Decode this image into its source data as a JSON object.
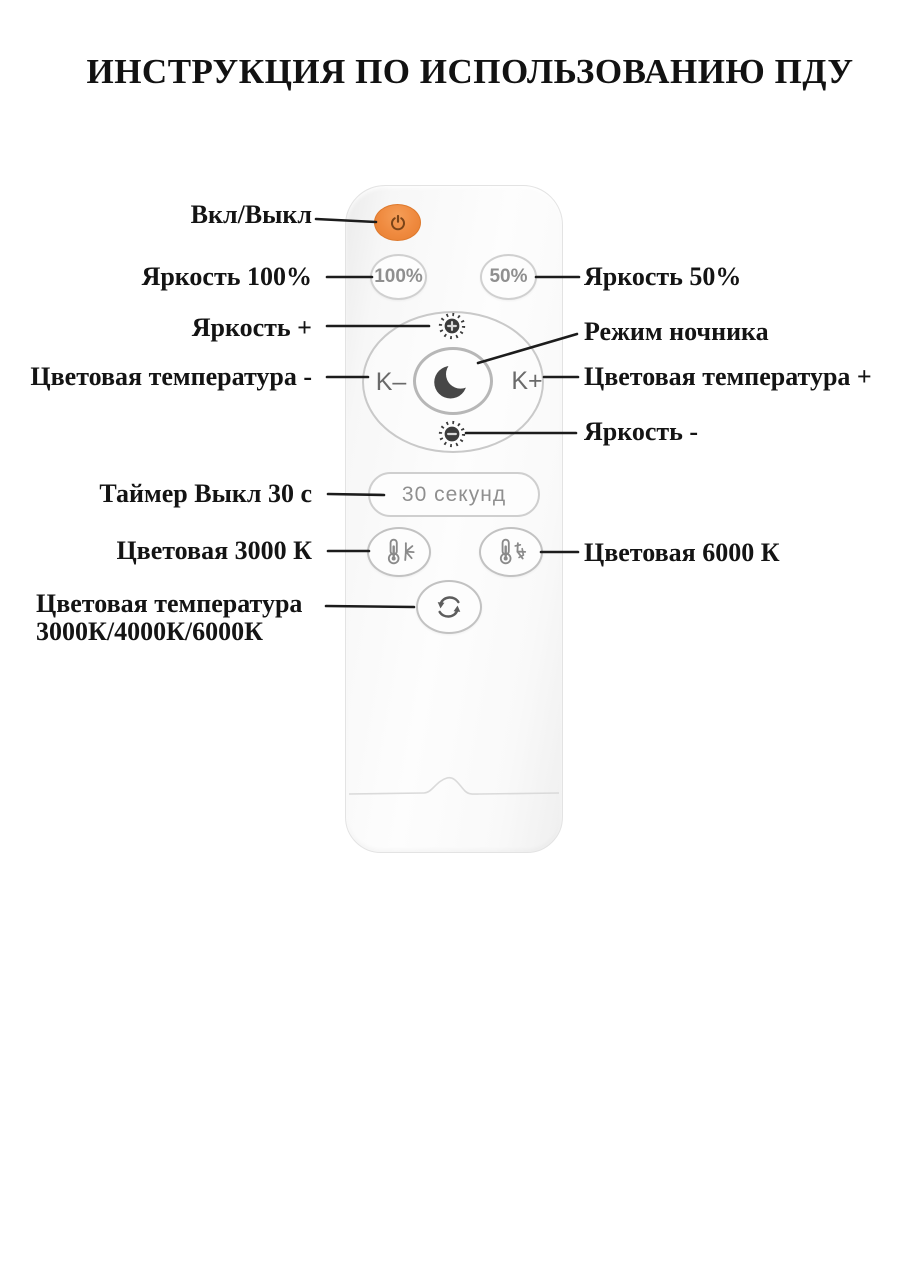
{
  "title": "ИНСТРУКЦИЯ ПО ИСПОЛЬЗОВАНИЮ ПДУ",
  "annotations": {
    "power": "Вкл/Выкл",
    "brightness_100": "Яркость 100%",
    "brightness_50": "Яркость 50%",
    "brightness_plus": "Яркость +",
    "night_mode": "Режим ночника",
    "color_temp_minus": "Цветовая температура -",
    "color_temp_plus": "Цветовая температура +",
    "brightness_minus": "Яркость -",
    "timer_off_30": "Таймер Выкл 30 с",
    "color_3000": "Цветовая 3000 К",
    "color_6000": "Цветовая 6000 К",
    "color_cycle_line1": "Цветовая температура",
    "color_cycle_line2": "3000К/4000К/6000К"
  },
  "remote": {
    "buttons": {
      "brightness_100_label": "100%",
      "brightness_50_label": "50%",
      "k_minus_label": "K–",
      "k_plus_label": "K+",
      "timer_label": "30 секунд"
    },
    "icons": {
      "power": "power-icon",
      "brightness_plus": "sun-plus-icon",
      "brightness_minus": "sun-minus-icon",
      "night_mode": "moon-icon",
      "color_warm": "thermometer-warm-icon",
      "color_cold": "thermometer-cold-icon",
      "color_cycle": "cycle-arrows-icon"
    },
    "colors": {
      "power_button": "#ef8a3f",
      "body": "#f6f6f6",
      "button_border": "#c9c9c9",
      "button_text": "#8f8f8f",
      "icon_dark": "#3d3d3d",
      "label_text": "#141414"
    }
  }
}
